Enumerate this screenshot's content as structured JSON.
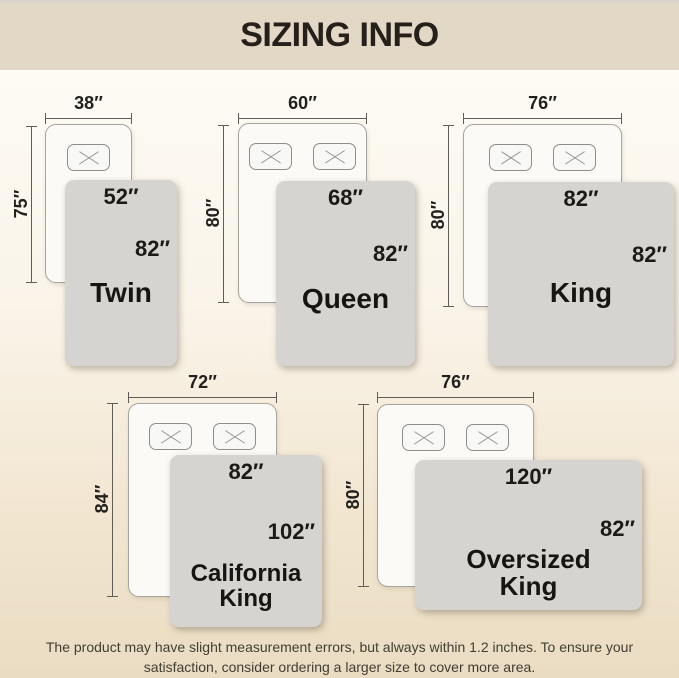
{
  "header": {
    "title": "SIZING INFO"
  },
  "footer": {
    "disclaimer": "The product may have slight measurement errors, but always within 1.2 inches. To ensure your satisfaction, consider ordering a larger size to cover more area."
  },
  "sizes": [
    {
      "name": "Twin",
      "mattress_width": "38″",
      "mattress_length": "75″",
      "blanket_width": "52″",
      "blanket_length": "82″",
      "pillows": 1
    },
    {
      "name": "Queen",
      "mattress_width": "60″",
      "mattress_length": "80″",
      "blanket_width": "68″",
      "blanket_length": "82″",
      "pillows": 2
    },
    {
      "name": "King",
      "mattress_width": "76″",
      "mattress_length": "80″",
      "blanket_width": "82″",
      "blanket_length": "82″",
      "pillows": 2
    },
    {
      "name": "California King",
      "mattress_width": "72″",
      "mattress_length": "84″",
      "blanket_width": "82″",
      "blanket_length": "102″",
      "pillows": 2
    },
    {
      "name": "Oversized King",
      "mattress_width": "76″",
      "mattress_length": "80″",
      "blanket_width": "120″",
      "blanket_length": "82″",
      "pillows": 2
    }
  ],
  "colors": {
    "header_bg": "#E3D8C5",
    "background_bottom": "#EADCC2",
    "mattress_fill": "#FBFAF7",
    "blanket_fill": "#D5D4D1",
    "dimension_line": "#5F5D57",
    "text_dark": "#1D1C19"
  }
}
